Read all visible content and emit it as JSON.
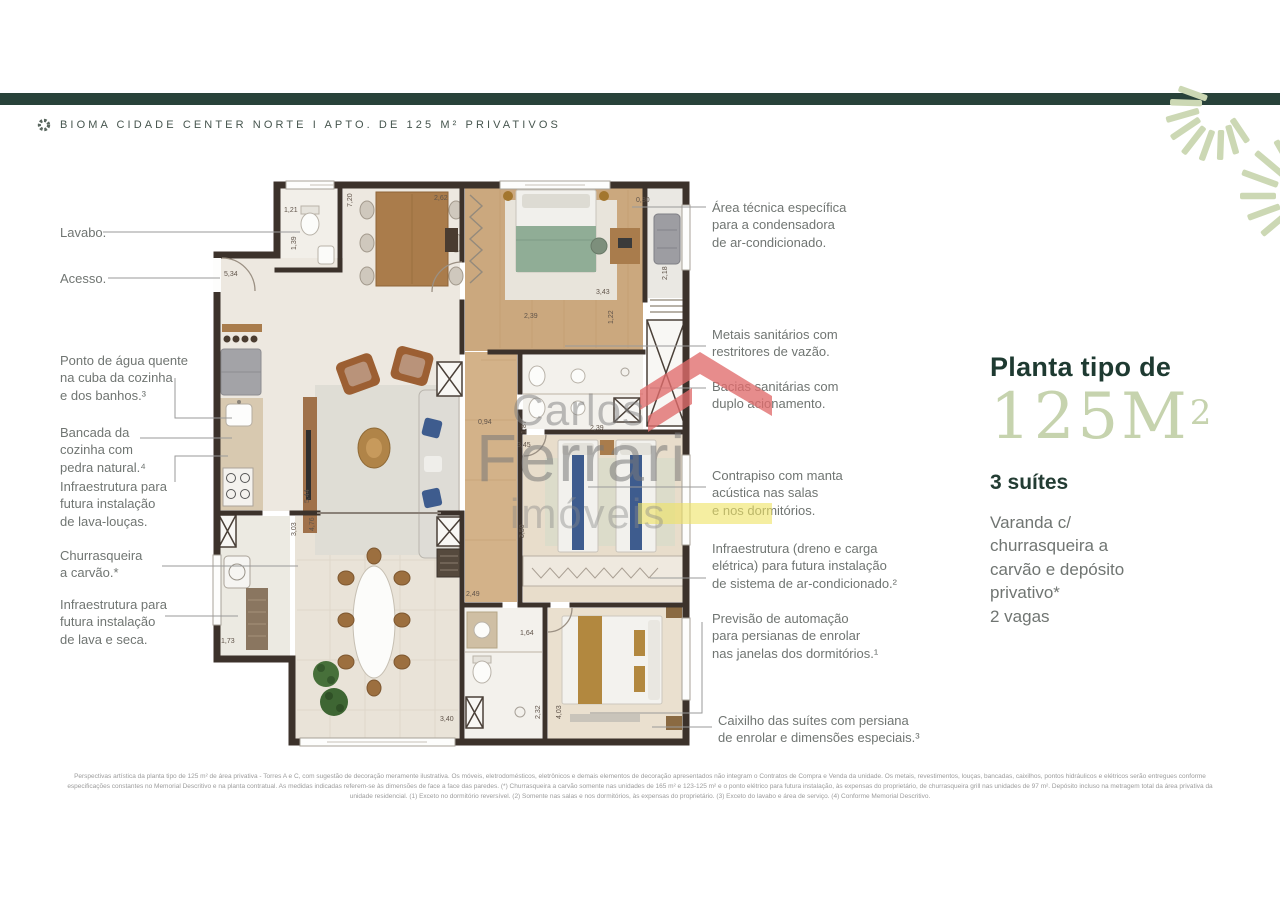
{
  "header": {
    "title": "BIOMA CIDADE CENTER NORTE I APTO. DE 125 M² PRIVATIVOS",
    "logo_icon": "segmented-ring"
  },
  "colors": {
    "header_bar": "#28423A",
    "accent_sage": "#C6D3AE",
    "panel_dark": "#1E3A31",
    "wall_brown": "#3C322B",
    "watermark_red": "#E06C6C",
    "watermark_yellow": "#EFE262"
  },
  "callouts_left": [
    {
      "text": "Lavabo."
    },
    {
      "text": "Acesso."
    },
    {
      "text": "Ponto de água quente\nna cuba da cozinha\ne dos banhos.³"
    },
    {
      "text": "Bancada da\ncozinha com\npedra natural.⁴"
    },
    {
      "text": "Infraestrutura para\nfutura instalação\nde lava-louças."
    },
    {
      "text": "Churrasqueira\na carvão.*"
    },
    {
      "text": "Infraestrutura para\nfutura instalação\nde lava e seca."
    }
  ],
  "callouts_right": [
    {
      "text": "Área técnica específica\npara a condensadora\nde ar-condicionado."
    },
    {
      "text": "Metais sanitários com\nrestritores de vazão."
    },
    {
      "text": "Bacias sanitárias com\nduplo acionamento."
    },
    {
      "text": "Contrapiso com manta\nacústica nas salas\ne nos dormitórios."
    },
    {
      "text": "Infraestrutura (dreno e carga\nelétrica) para futura instalação\nde sistema de ar-condicionado.²"
    },
    {
      "text": "Previsão de automação\npara persianas de enrolar\nnas janelas dos dormitórios.¹"
    },
    {
      "text": "Caixilho das suítes com persiana\nde enrolar e dimensões especiais.³"
    }
  ],
  "panel": {
    "kicker": "Planta tipo de",
    "area_value": "125M",
    "area_sup": "2",
    "suites": "3 suítes",
    "features": "Varanda c/\nchurrasqueira a\ncarvão e depósito\nprivativo*\n2 vagas"
  },
  "watermark": {
    "line1": "Carlos",
    "line2": "Ferrari",
    "line3": "imóveis"
  },
  "plan": {
    "dims": [
      {
        "v": "1,21"
      },
      {
        "v": "1,39"
      },
      {
        "v": "7,20"
      },
      {
        "v": "2,62"
      },
      {
        "v": "0,80"
      },
      {
        "v": "3,43"
      },
      {
        "v": "2,18"
      },
      {
        "v": "5,34"
      },
      {
        "v": "2,39"
      },
      {
        "v": "1,22"
      },
      {
        "v": "0,94"
      },
      {
        "v": "1,87"
      },
      {
        "v": "2,39"
      },
      {
        "v": "3,45"
      },
      {
        "v": "3,50"
      },
      {
        "v": "3,03"
      },
      {
        "v": "4,76"
      },
      {
        "v": "5,44"
      },
      {
        "v": "1,73"
      },
      {
        "v": "2,49"
      },
      {
        "v": "1,64"
      },
      {
        "v": "2,32"
      },
      {
        "v": "4,03"
      },
      {
        "v": "3,40"
      }
    ]
  },
  "disclaimer": {
    "line1": "Perspectivas artística da planta tipo de 125 m² de área privativa - Torres A e C, com sugestão de decoração meramente ilustrativa. Os móveis, eletrodomésticos, eletrônicos e demais elementos de decoração apresentados não integram o Contratos de Compra e Venda da unidade. Os metais, revestimentos, louças, bancadas, caixilhos, pontos hidráulicos e elétricos serão entregues conforme",
    "line2": "especificações constantes no Memorial Descritivo e na planta contratual. As medidas indicadas referem-se às dimensões de face a face das paredes. (*) Churrasqueira a carvão somente nas unidades de 165 m² e 123-125 m² e o ponto elétrico para futura instalação, às expensas do proprietário, de churrasqueira grill nas unidades de 97 m². Depósito incluso na metragem total da área privativa da",
    "line3": "unidade residencial. (1) Exceto no dormitório reversível. (2) Somente nas salas e nos dormitórios, às expensas do proprietário. (3) Exceto do lavabo e área de serviço. (4) Conforme Memorial Descritivo."
  }
}
